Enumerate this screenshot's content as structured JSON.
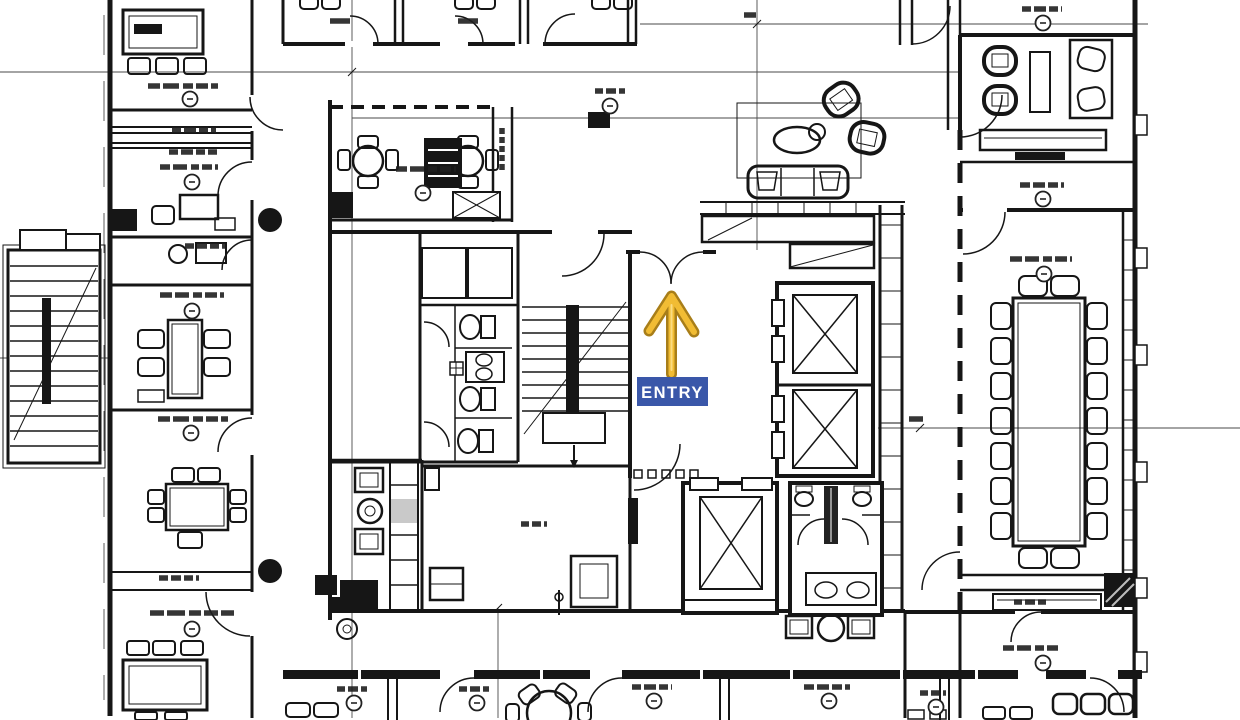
{
  "page": {
    "kind": "architectural-floor-plan",
    "description": "Black-and-white CAD office floor plan screenshot with a highlighted entrance annotation"
  },
  "entry_marker": {
    "label": "ENTRY",
    "label_bg": "#3A57A9",
    "label_text_color": "#FFFFFF",
    "arrow_fill": "#F1BC34",
    "arrow_outline": "#A87E19"
  },
  "palette": {
    "paper": "#FFFFFF",
    "ink": "#161616",
    "grid": "#4A4A4A",
    "glass": "#C9C9C9"
  },
  "features": {
    "elevator_shafts": 3,
    "staircases": 2,
    "restroom_blocks": 2,
    "annotation_note": "room-name tags present but illegible at source resolution"
  }
}
